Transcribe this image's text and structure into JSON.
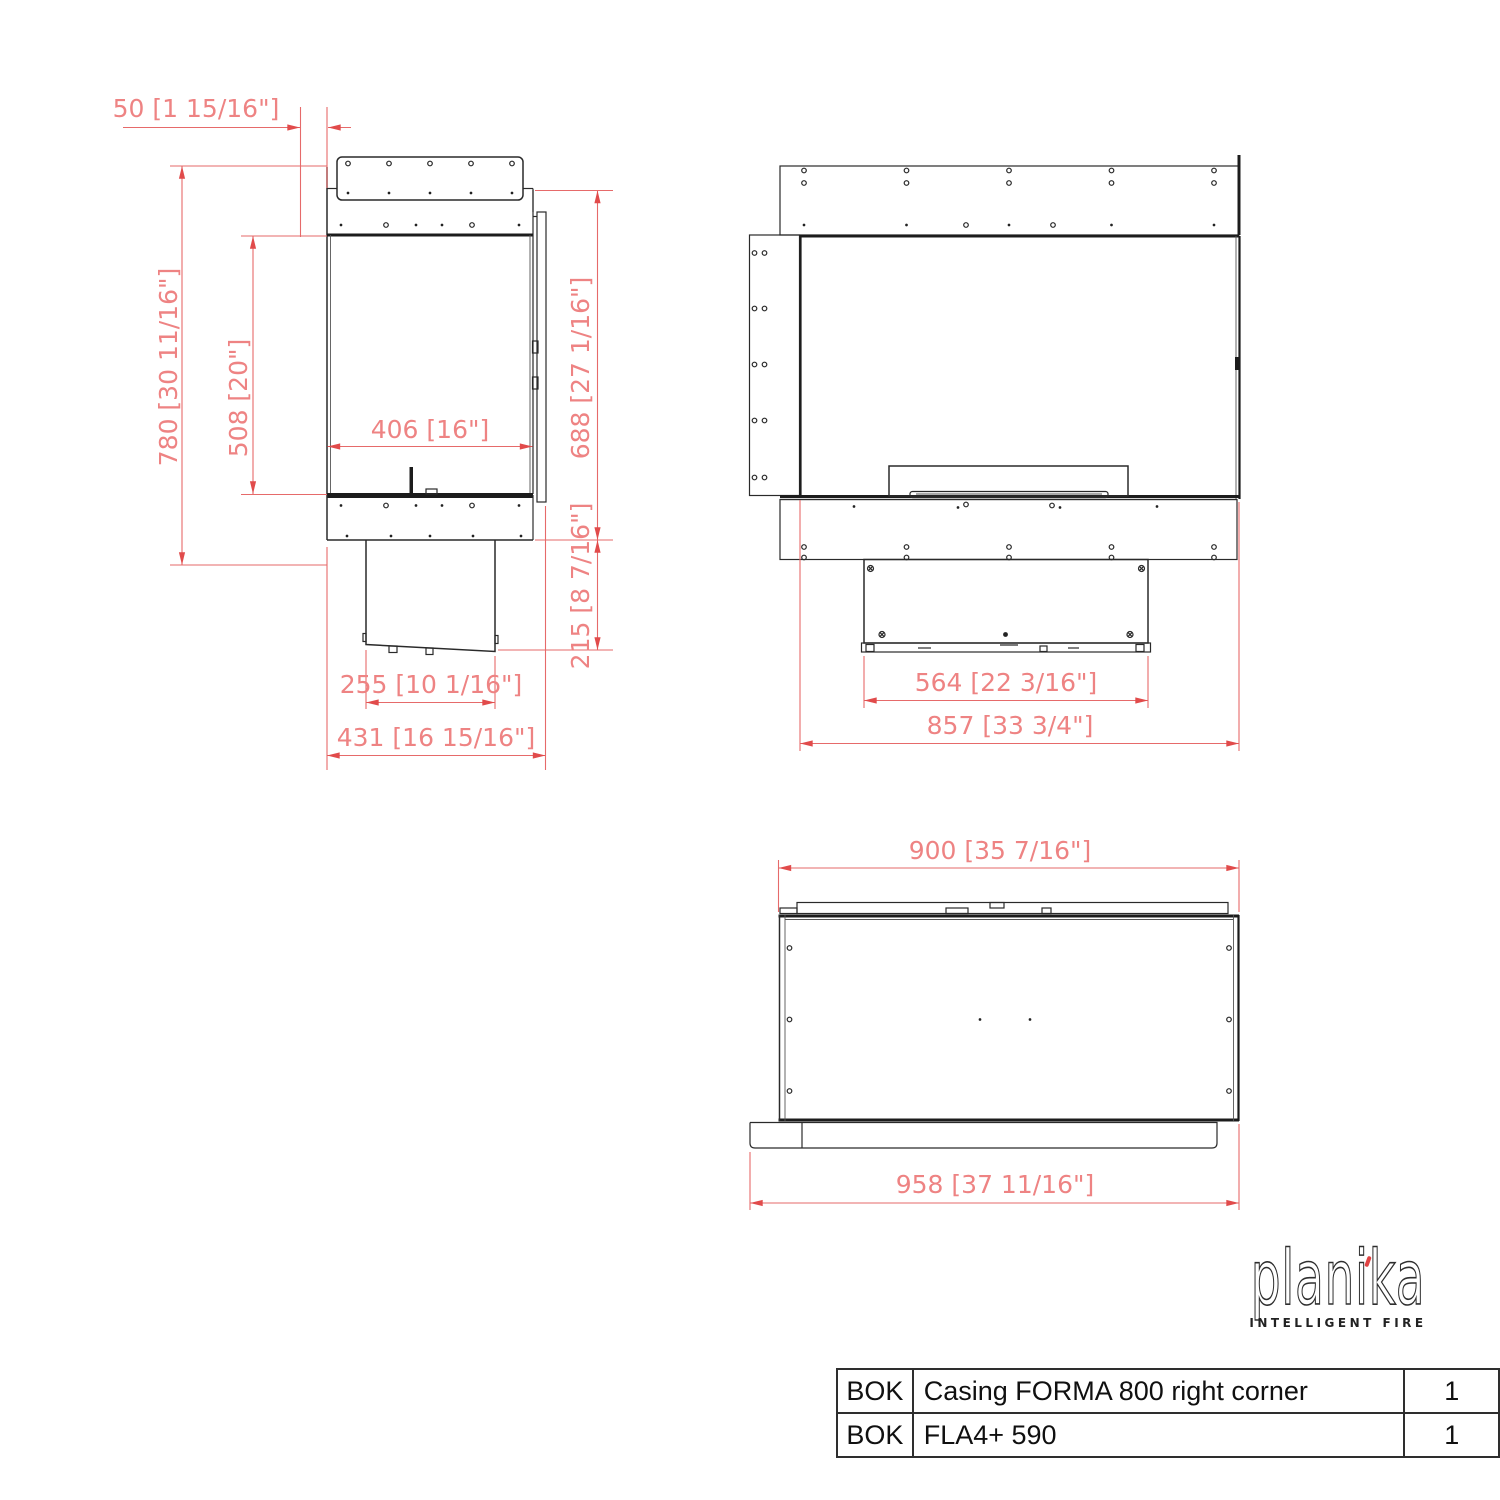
{
  "drawing": {
    "side_view": {
      "dim_offset_top": "50 [1 15/16\"]",
      "dim_height_total": "780 [30 11/16\"]",
      "dim_height_opening": "508 [20\"]",
      "dim_width_opening": "406 [16\"]",
      "dim_height_glass": "688 [27 1/16\"]",
      "dim_height_underbox": "215 [8 7/16\"]",
      "dim_depth_underbox": "255 [10 1/16\"]",
      "dim_depth_total": "431 [16 15/16\"]"
    },
    "front_view": {
      "dim_width_underbox": "564 [22 3/16\"]",
      "dim_width_total": "857 [33 3/4\"]"
    },
    "top_view": {
      "dim_width_top": "900 [35 7/16\"]",
      "dim_width_total": "958 [37 11/16\"]"
    },
    "colors": {
      "dimension_red": "#e66a6a",
      "drawing_black": "#1c1c1c",
      "logo_accent_red": "#e04343"
    }
  },
  "logo": {
    "brand": "planika",
    "tagline": "INTELLIGENT FIRE"
  },
  "parts_table": {
    "rows": [
      {
        "code": "BOK",
        "description": "Casing FORMA 800 right corner",
        "qty": "1"
      },
      {
        "code": "BOK",
        "description": "FLA4+ 590",
        "qty": "1"
      }
    ]
  }
}
